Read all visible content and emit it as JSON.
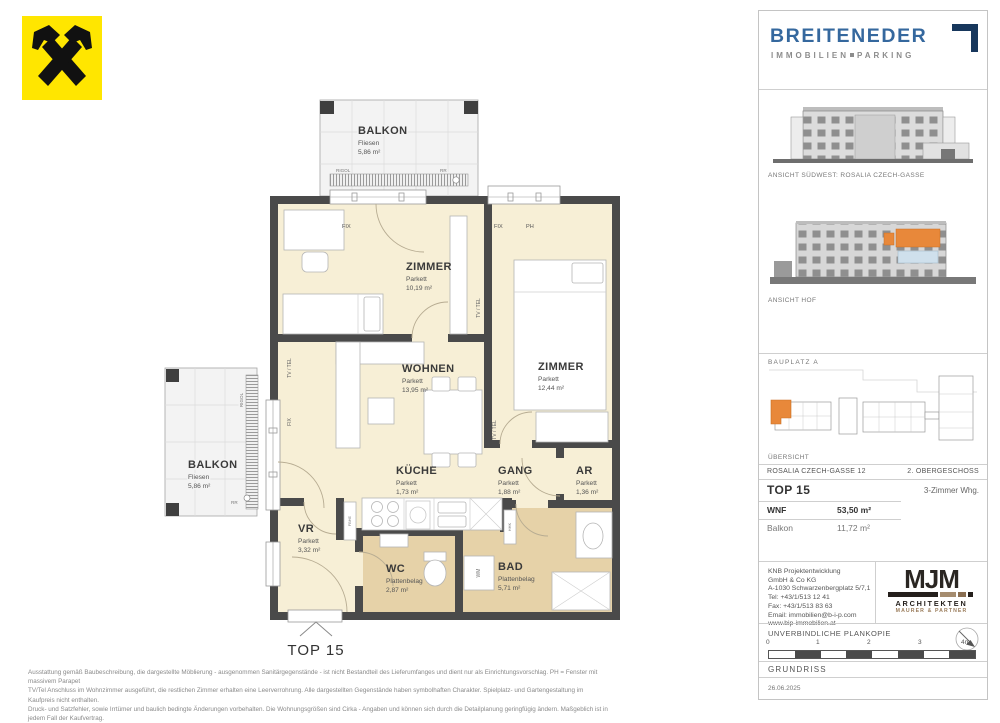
{
  "colors": {
    "wall": "#4a4a4a",
    "room_fill": "#f7efd6",
    "wet_room_fill": "#e6d2a8",
    "accent_orange": "#e8883a",
    "brand_blue": "#35689e",
    "brand_navy": "#17375c",
    "mjm_brown": "#9b7d5c",
    "raiffeisen_yellow": "#ffe600"
  },
  "plan": {
    "unit_label": "TOP 15",
    "balcony_top": {
      "name": "BALKON",
      "floor": "Fliesen",
      "area": "5,86 m²"
    },
    "balcony_left": {
      "name": "BALKON",
      "floor": "Fliesen",
      "area": "5,86 m²"
    },
    "rooms": {
      "zimmer1": {
        "name": "ZIMMER",
        "floor": "Parkett",
        "area": "10,19 m²"
      },
      "zimmer2": {
        "name": "ZIMMER",
        "floor": "Parkett",
        "area": "12,44 m²"
      },
      "wohnen": {
        "name": "WOHNEN",
        "floor": "Parkett",
        "area": "13,95 m²"
      },
      "kueche": {
        "name": "KÜCHE",
        "floor": "Parkett",
        "area": "1,73 m²"
      },
      "gang": {
        "name": "GANG",
        "floor": "Parkett",
        "area": "1,88 m²"
      },
      "ar": {
        "name": "AR",
        "floor": "Parkett",
        "area": "1,36 m²"
      },
      "vr": {
        "name": "VR",
        "floor": "Parkett",
        "area": "3,32 m²"
      },
      "wc": {
        "name": "WC",
        "floor": "Plattenbelag",
        "area": "2,87 m²"
      },
      "bad": {
        "name": "BAD",
        "floor": "Plattenbelag",
        "area": "5,71 m²"
      }
    },
    "annotations": {
      "fix": "FIX",
      "ph": "PH",
      "tv_tel": "TV / TEL",
      "rigol": "RIGOL",
      "rr": "RR",
      "hhk": "HHK",
      "wm": "WM",
      "fbhe": "FBHE"
    }
  },
  "sidebar": {
    "brand": {
      "name": "BREITENEDER",
      "tagline_left": "IMMOBILIEN",
      "tagline_right": "PARKING"
    },
    "elevation1_caption": "ANSICHT SÜDWEST: ROSALIA CZECH-GASSE",
    "elevation2_caption": "ANSICHT HOF",
    "siteplan_label": "BAUPLATZ A",
    "siteplan_caption": "ÜBERSICHT",
    "info": {
      "street": "ROSALIA CZECH-GASSE 12",
      "floor": "2. OBERGESCHOSS",
      "unit": "TOP 15",
      "unit_type": "3-Zimmer Whg.",
      "wnf_label": "WNF",
      "wnf_value": "53,50 m²",
      "balcony_label": "Balkon",
      "balcony_value": "11,72 m²"
    },
    "developer": {
      "lines": [
        "KNB Projektentwicklung",
        "GmbH & Co KG",
        "A-1030 Schwarzenbergplatz 5/7,1",
        "Tel: +43/1/513 12 41",
        "Fax: +43/1/513 83 63",
        "Email: immobilien@b-i-p.com",
        "www.bip-immobilien.at"
      ]
    },
    "architects": {
      "logo": "MJM",
      "line1": "ARCHITEKTEN",
      "line2": "MAURER & PARTNER"
    },
    "footer": {
      "plan_copy": "UNVERBINDLICHE PLANKOPIE",
      "scale_ticks": [
        "0",
        "1",
        "2",
        "3",
        "4m"
      ],
      "drawing_type": "GRUNDRISS",
      "date": "26.06.2025"
    }
  },
  "disclaimer": {
    "line1": "Ausstattung gemäß Baubeschreibung, die dargestellte Möblierung - ausgenommen Sanitärgegenstände - ist nicht Bestandteil des Lieferumfanges und dient nur als Einrichtungsvorschlag. PH = Fenster mit massivem Parapet",
    "line2": "TV/Tel Anschluss im Wohnzimmer ausgeführt, die restlichen Zimmer erhalten eine Leerverrohrung. Alle dargestellten Gegenstände haben symbolhaften Charakter. Spielplatz- und Gartengestaltung im Kaufpreis nicht enthalten.",
    "line3": "Druck- und Satzfehler, sowie Irrtümer und baulich bedingte Änderungen vorbehalten. Die Wohnungsgrößen sind Cirka - Angaben und können sich durch die Detailplanung geringfügig ändern. Maßgeblich ist in jedem Fall der Kaufvertrag."
  }
}
